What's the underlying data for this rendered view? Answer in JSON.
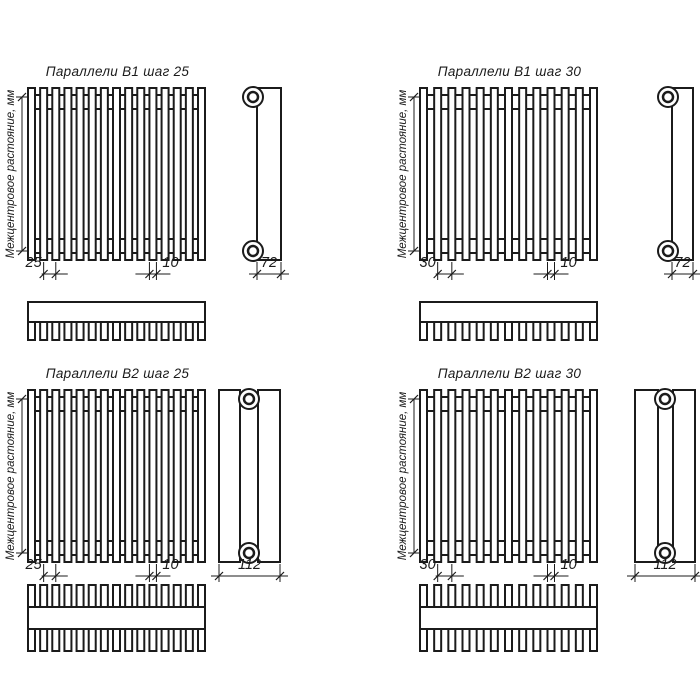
{
  "drawing": {
    "background": "#ffffff",
    "line_color": "#1b1b1b",
    "kind": "radiator technical drawing, 4 variants"
  },
  "panels": [
    {
      "id": "b1-step-25",
      "title": "Параллели В1 шаг 25",
      "axis_label": "Межцентровое растояние, мм",
      "pitch_label": "25",
      "tube_width_label": "10",
      "depth_label": "72",
      "variant": "B1",
      "tube_count": 15
    },
    {
      "id": "b1-step-30",
      "title": "Параллели В1 шаг 30",
      "axis_label": "Межцентровое растояние, мм",
      "pitch_label": "30",
      "tube_width_label": "10",
      "depth_label": "72",
      "variant": "B1",
      "tube_count": 13
    },
    {
      "id": "b2-step-25",
      "title": "Параллели В2 шаг 25",
      "axis_label": "Межцентровое растояние, мм",
      "pitch_label": "25",
      "tube_width_label": "10",
      "depth_label": "112",
      "variant": "B2",
      "tube_count": 15
    },
    {
      "id": "b2-step-30",
      "title": "Параллели В2 шаг 30",
      "axis_label": "Межцентровое растояние, мм",
      "pitch_label": "30",
      "tube_width_label": "10",
      "depth_label": "112",
      "variant": "B2",
      "tube_count": 13
    }
  ]
}
